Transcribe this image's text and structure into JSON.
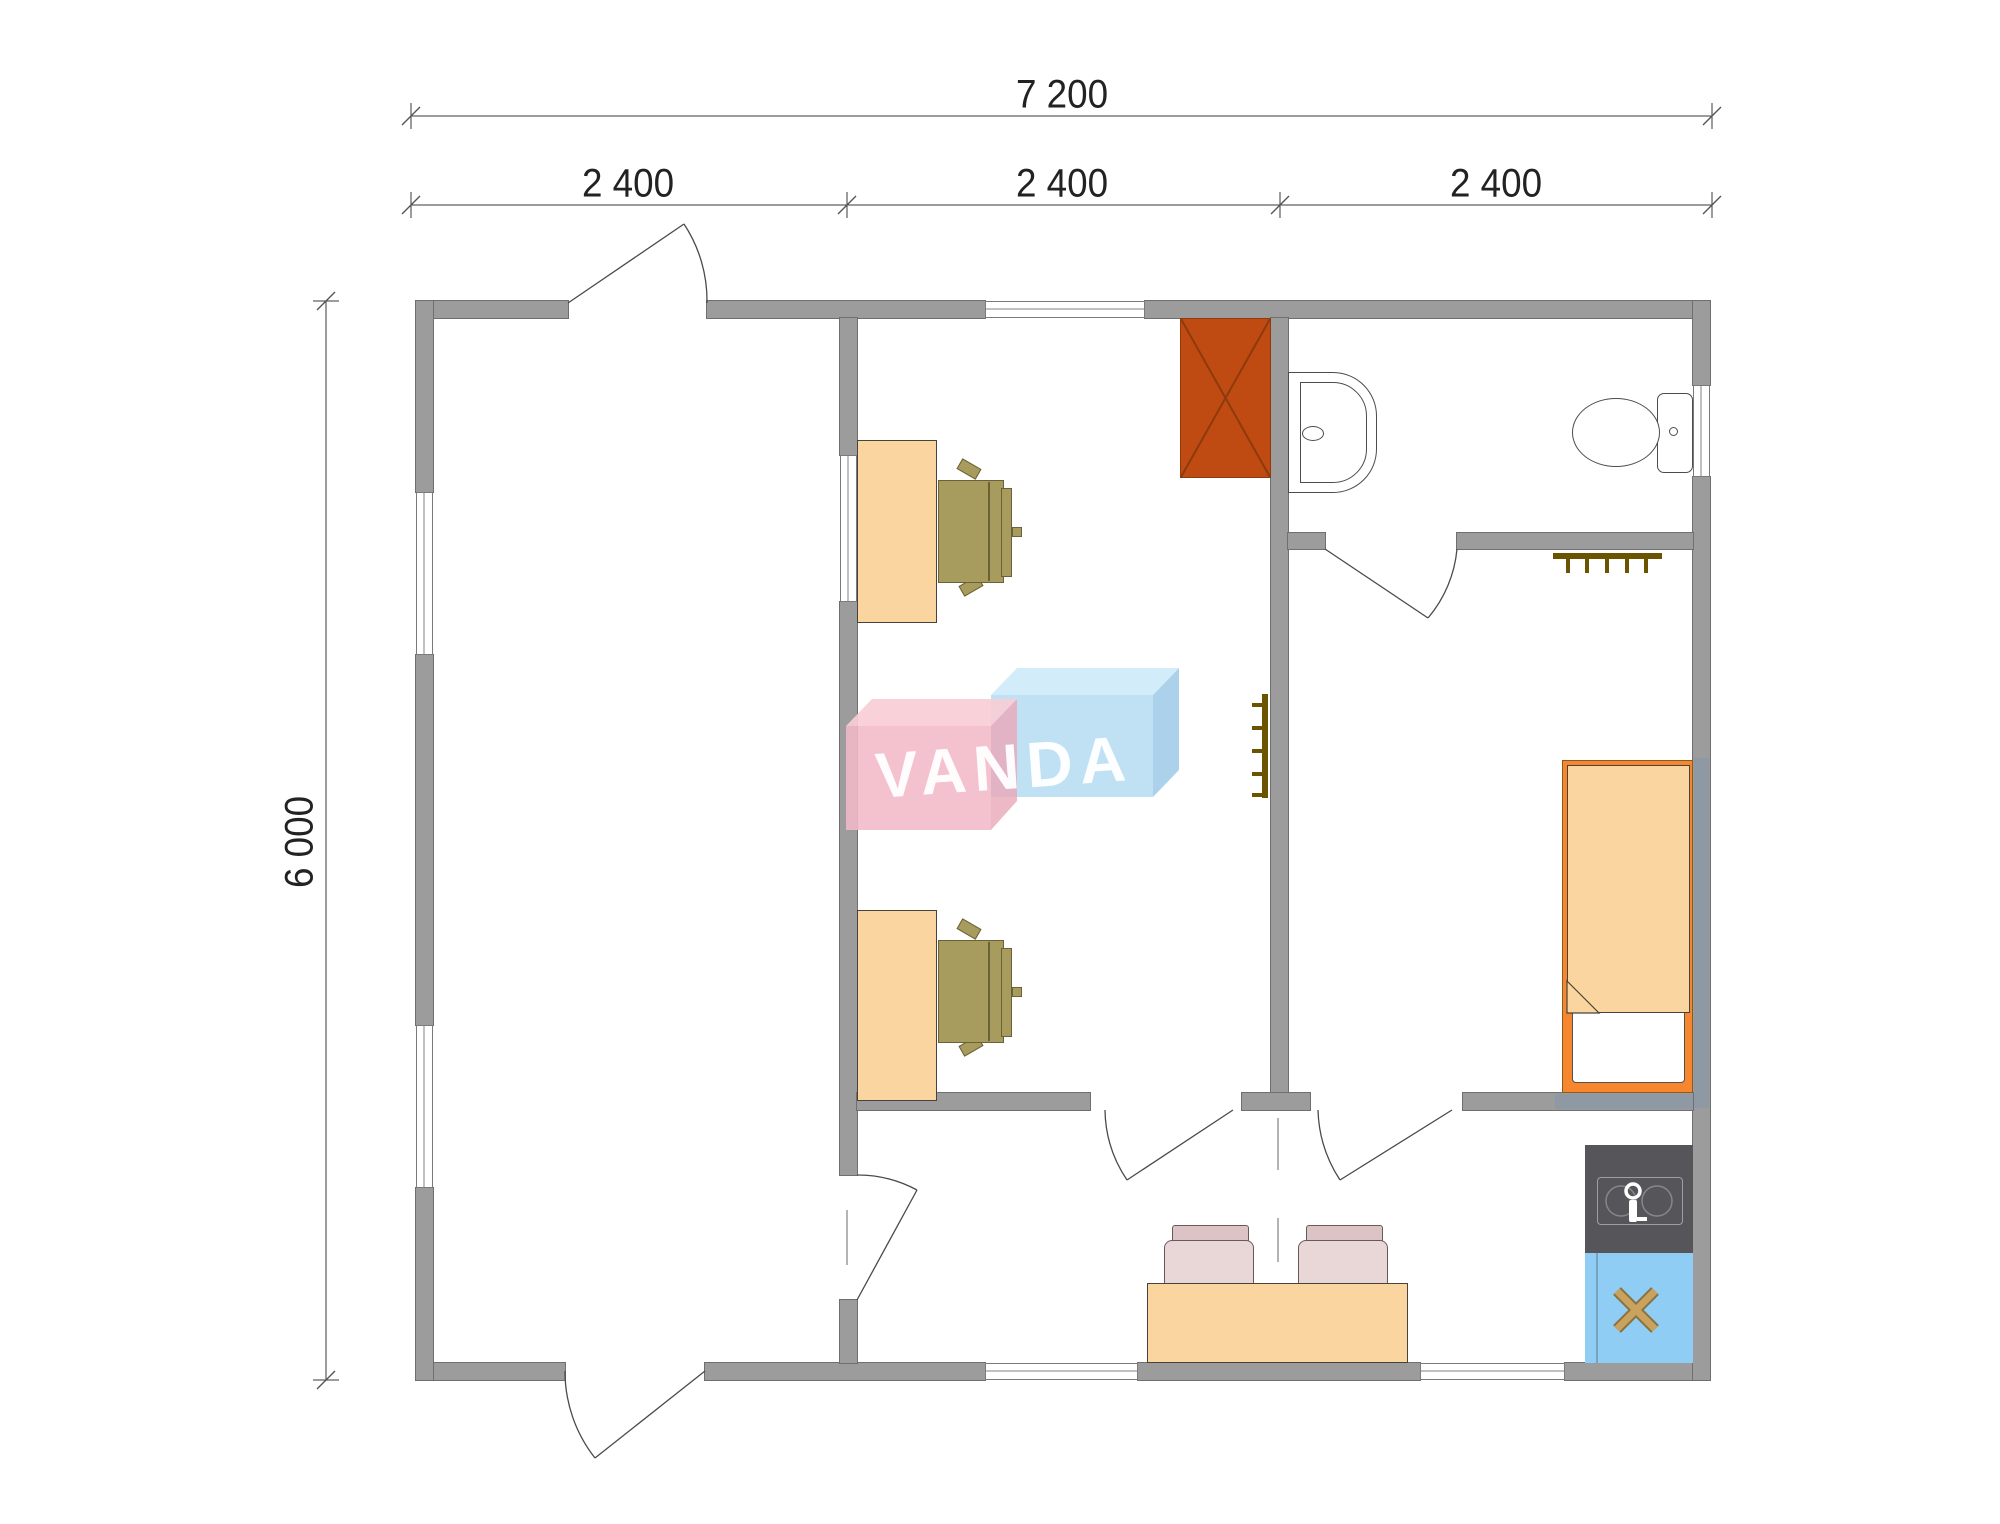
{
  "watermark": {
    "text": "VANDA"
  },
  "dimensions": {
    "overall_width_label": "7 200",
    "segment_labels": [
      "2 400",
      "2 400",
      "2 400"
    ],
    "overall_height_label": "6 000"
  },
  "colors": {
    "wall": "#9c9c9c",
    "wall_border": "#6f6f6f",
    "wall_tint": "#8e99a4",
    "line": "#4a4a4a",
    "dim": "#222222",
    "furniture_light": "#fbd5a0",
    "furniture_border": "#45433b",
    "bed_frame": "#f6872f",
    "bed_border": "#8a5a20",
    "chair": "#a89b5e",
    "chair_border": "#6b6136",
    "wardrobe": "#bf4a12",
    "wardrobe_line": "#8d3a0d",
    "counter": "#56565a",
    "sink_line": "#9ba0a5",
    "stove": "#8fcdf5",
    "stove_x": "#c9a25e",
    "stove_x_dark": "#8a7240",
    "tchair_seat": "#e9d7d7",
    "tchair_back": "#dcc3c6",
    "tchair_border": "#6a5858",
    "rack": "#6b5300",
    "logo_pink": "#f3bac7",
    "logo_pink_top": "#f7cdd6",
    "logo_pink_side": "#e8a8b8",
    "logo_blue": "#b5dcf2",
    "logo_blue_top": "#cfeaf8",
    "logo_blue_side": "#9ccae6"
  },
  "rooms": [
    "garage-hall",
    "office",
    "bathroom",
    "bedroom",
    "kitchen-corridor"
  ],
  "furniture_icons": [
    "wardrobe-x-icon",
    "office-desk",
    "office-chair",
    "bathroom-sink-icon",
    "toilet-icon",
    "coat-rack-icon",
    "single-bed",
    "pillow",
    "dining-table",
    "dining-chair",
    "kitchen-counter",
    "faucet-icon",
    "stove-x-icon"
  ]
}
